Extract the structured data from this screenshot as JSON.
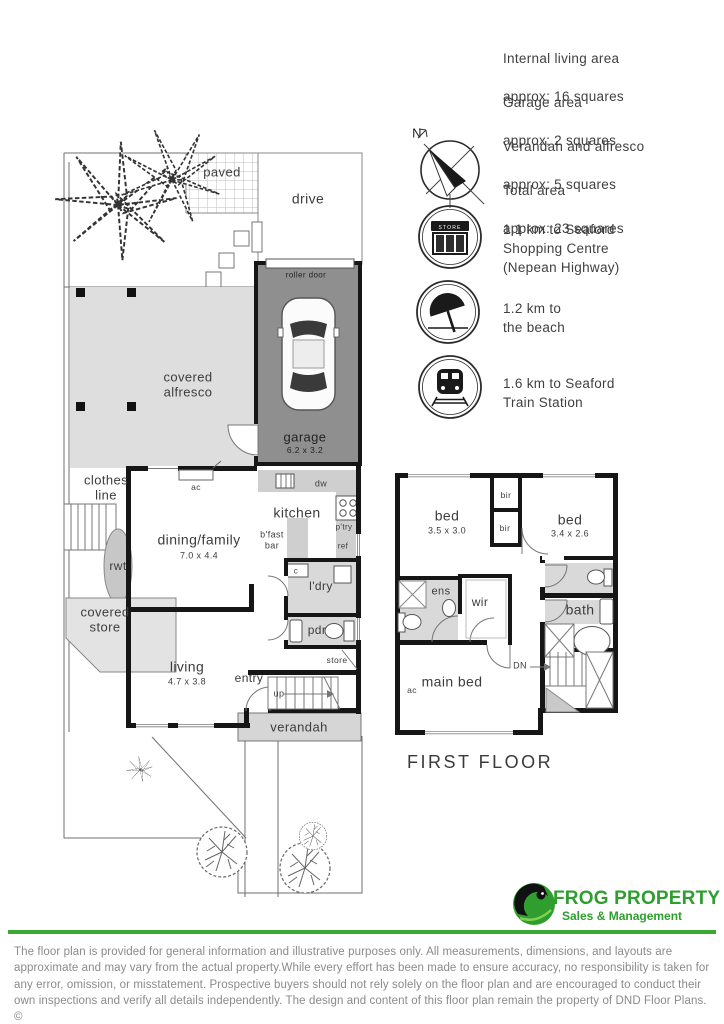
{
  "info_panel": {
    "areas": [
      {
        "name": "Internal living area",
        "value": "approx: 16 squares"
      },
      {
        "name": "Garage area",
        "value": "approx; 2 squares"
      },
      {
        "name": "Verandah and alfresco",
        "value": "approx: 5 squares"
      },
      {
        "name": "Total area",
        "value": "approx: 23 squares"
      }
    ],
    "landmarks": [
      {
        "icon": "shop-icon",
        "sign": "STORE",
        "text": "1.1 km to Seaford\nShopping Centre\n(Nepean Highway)"
      },
      {
        "icon": "beach-umbrella-icon",
        "text": "1.2 km to\nthe beach"
      },
      {
        "icon": "train-icon",
        "text": "1.6 km to Seaford\nTrain Station"
      }
    ]
  },
  "compass": {
    "north": "N"
  },
  "ground_floor": {
    "paved": "paved",
    "drive": "drive",
    "roller_door": "roller door",
    "garage": "garage",
    "garage_dims": "6.2 x 3.2",
    "alfresco": "covered\nalfresco",
    "clothes_line": "clothes\nline",
    "rwt": "rwt",
    "covered_store": "covered\nstore",
    "ac": "ac",
    "dw": "dw",
    "kitchen": "kitchen",
    "bfast_bar": "b'fast\nbar",
    "ptry": "p'try",
    "ref": "ref",
    "c": "c",
    "ldry": "l'dry",
    "pdr": "pdr",
    "dining": "dining/family",
    "dining_dims": "7.0 x 4.4",
    "living": "living",
    "living_dims": "4.7 x 3.8",
    "entry": "entry",
    "up": "up",
    "store": "store",
    "verandah": "verandah"
  },
  "first_floor": {
    "title": "FIRST FLOOR",
    "bed1": "bed",
    "bed1_dims": "3.5 x 3.0",
    "bed2": "bed",
    "bed2_dims": "3.4 x 2.6",
    "bir1": "bir",
    "bir2": "bir",
    "ens": "ens",
    "wir": "wir",
    "bath": "bath",
    "dn": "DN",
    "ac": "ac",
    "main_bed": "main bed"
  },
  "branding": {
    "company": "FROG PROPERTY",
    "tagline": "Sales & Management",
    "accent_green": "#3aaa35",
    "logo_green": "#2f9e2f"
  },
  "colors": {
    "wall": "#161616",
    "garage_fill": "#8f8f8f",
    "light_fill": "#dcdcdc"
  },
  "disclaimer": "The floor plan is provided for general information and illustrative purposes only. All measurements, dimensions, and layouts are approximate and may vary from the actual property.While every effort has been made to ensure accuracy, no responsibility is taken for any error, omission, or misstatement. Prospective buyers should not rely solely on the floor plan and are encouraged to conduct their own inspections and verify all details independently. The design and content of this floor plan remain the property of DND Floor Plans. ©"
}
